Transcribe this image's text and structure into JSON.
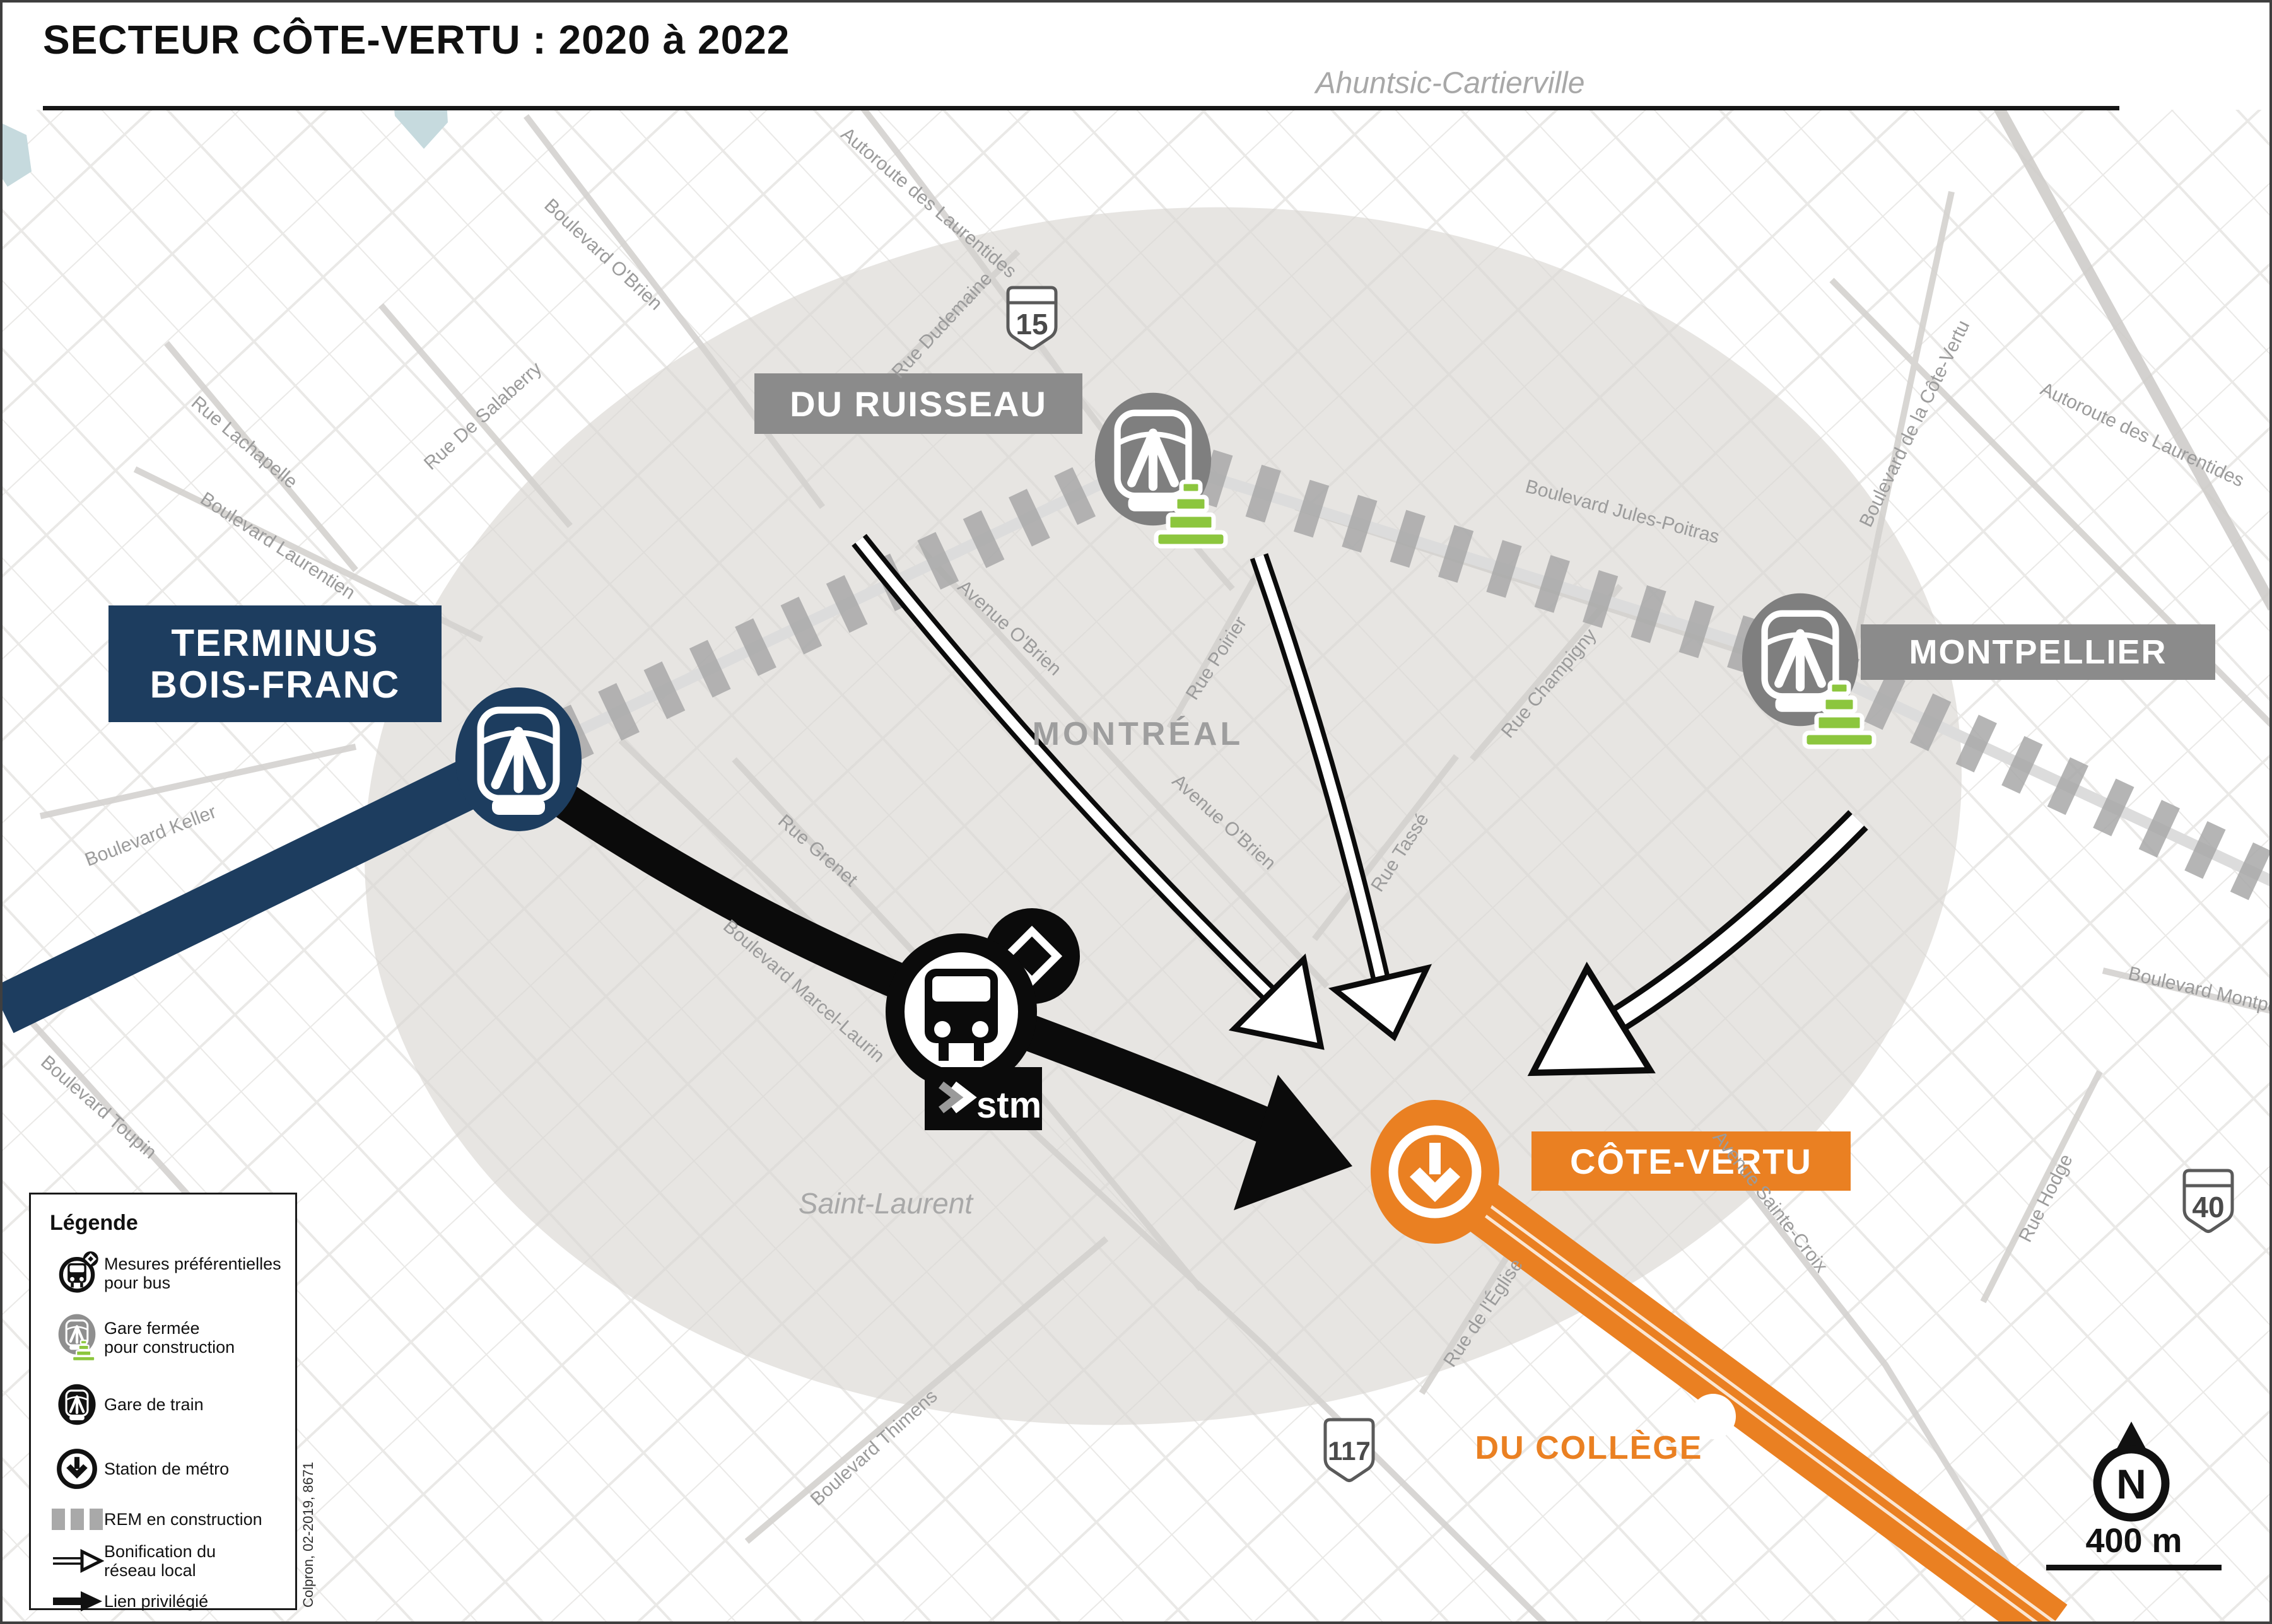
{
  "title": "SECTEUR CÔTE-VERTU : 2020 à 2022",
  "colors": {
    "navy": "#1d3d5f",
    "orange": "#ea8022",
    "station_label_gray": "#8b8b8b",
    "cone_green": "#8cc63e",
    "rem_dash_gray": "#a8a8a8",
    "sector_fill": "#e7e5e2",
    "street_label_gray": "#9b9b9b"
  },
  "stations": {
    "terminus_bois_franc": {
      "label": "TERMINUS\nBOIS-FRANC"
    },
    "du_ruisseau": {
      "label": "DU RUISSEAU"
    },
    "montpellier": {
      "label": "MONTPELLIER"
    },
    "cote_vertu": {
      "label": "CÔTE-VERTU"
    },
    "du_college": {
      "label": "DU COLLÈGE"
    }
  },
  "regions": {
    "north_borough": "Ahuntsic-Cartierville",
    "city": "MONTRÉAL",
    "south_borough": "Saint-Laurent"
  },
  "streets": [
    {
      "id": "autoroute-laurentides-ouest",
      "name": "Autoroute des Laurentides"
    },
    {
      "id": "rue-dudemaine",
      "name": "Rue Dudemaine"
    },
    {
      "id": "boulevard-obrien",
      "name": "Boulevard O'Brien"
    },
    {
      "id": "rue-de-salaberry",
      "name": "Rue De Salaberry"
    },
    {
      "id": "rue-lachapelle",
      "name": "Rue Lachapelle"
    },
    {
      "id": "boulevard-laurentien",
      "name": "Boulevard Laurentien"
    },
    {
      "id": "boulevard-keller",
      "name": "Boulevard Keller"
    },
    {
      "id": "boulevard-toupin",
      "name": "Boulevard Toupin"
    },
    {
      "id": "boulevard-thimens",
      "name": "Boulevard Thimens"
    },
    {
      "id": "rue-grenet",
      "name": "Rue Grenet"
    },
    {
      "id": "boulevard-marcel-laurin",
      "name": "Boulevard Marcel-Laurin"
    },
    {
      "id": "avenue-obrien-nord",
      "name": "Avenue O'Brien"
    },
    {
      "id": "rue-poirier",
      "name": "Rue Poirier"
    },
    {
      "id": "avenue-obrien-sud",
      "name": "Avenue O'Brien"
    },
    {
      "id": "rue-tasse",
      "name": "Rue Tassé"
    },
    {
      "id": "rue-champigny",
      "name": "Rue Champigny"
    },
    {
      "id": "boulevard-jules-poitras",
      "name": "Boulevard Jules-Poitras"
    },
    {
      "id": "boulevard-cote-vertu",
      "name": "Boulevard de la Côte-Vertu"
    },
    {
      "id": "autoroute-laurentides-est",
      "name": "Autoroute des Laurentides"
    },
    {
      "id": "avenue-sainte-croix",
      "name": "Avenue Sainte-Croix"
    },
    {
      "id": "rue-eglise",
      "name": "Rue de l'Église"
    },
    {
      "id": "rue-hodge",
      "name": "Rue Hodge"
    },
    {
      "id": "boulevard-montpellier",
      "name": "Boulevard Montpellier"
    }
  ],
  "shields": [
    {
      "num": "15",
      "type": "autoroute"
    },
    {
      "num": "117",
      "type": "route"
    },
    {
      "num": "40",
      "type": "autoroute"
    }
  ],
  "stm_logo_text": "stm",
  "north_label": "N",
  "scale_label": "400 m",
  "legend": {
    "title": "Légende",
    "items": [
      {
        "icon": "bus-preferential",
        "label": "Mesures préférentielles\npour bus"
      },
      {
        "icon": "station-closed",
        "label": "Gare fermée\npour construction"
      },
      {
        "icon": "train-station",
        "label": "Gare de train"
      },
      {
        "icon": "metro-station",
        "label": "Station de métro"
      },
      {
        "icon": "rem-construction",
        "label": "REM en construction"
      },
      {
        "icon": "local-network",
        "label": "Bonification du\nréseau local"
      },
      {
        "icon": "priority-link",
        "label": "Lien privilégié"
      }
    ],
    "attribution": "Colpron, 02-2019, 8671"
  }
}
